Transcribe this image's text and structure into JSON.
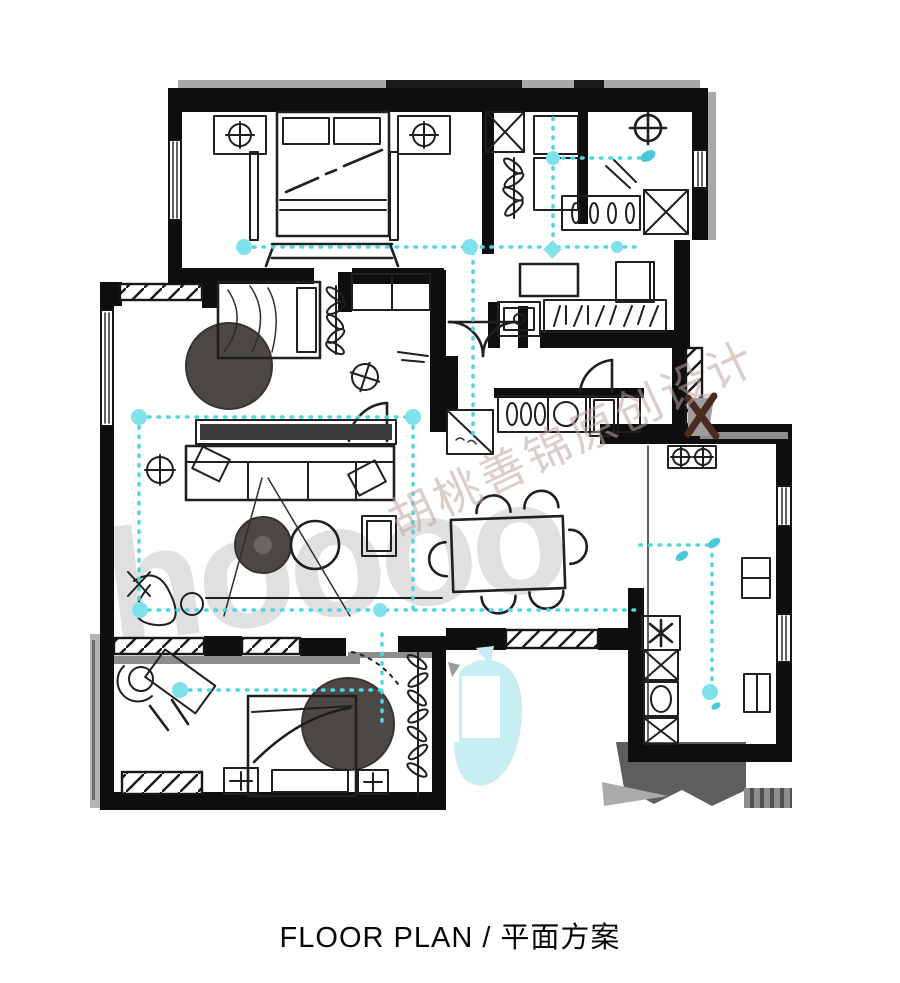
{
  "caption": {
    "text": "FLOOR PLAN / 平面方案"
  },
  "watermark": {
    "logo_text": "hoooo",
    "brand_text": "胡桃善锦原创设计"
  },
  "palette": {
    "wall_black": "#0e0e0e",
    "sketch_line": "#1f1f1f",
    "ceiling_line_cyan": "#52d5e3",
    "ceiling_node_cyan": "#7fe2ea",
    "highlight_cyan": "#c7eef3",
    "rug_dark_gray": "#4c4846",
    "window_sill_gray": "#8d8d8d",
    "shadow_gray": "#5e5e5e",
    "demolition_mark_brown": "#4a2c20",
    "logo_watermark_gray": "#e0e0e0",
    "brand_watermark_tone": "#bda69f"
  },
  "plan": {
    "kind": "hand-drawn residential floor plan sketch",
    "depicted_elements": [
      "double-bed-with-nightstands-and-lamps",
      "bed-bench",
      "wardrobe-hangers",
      "walk-in-closet-shelving",
      "shower-head-symbol",
      "towel-rail",
      "column-x-hatch",
      "entry-double-door",
      "coat-closet-hangers",
      "washbasin",
      "hall-table-and-chair",
      "shoe-cabinet",
      "kitchen-stove-burners",
      "kitchen-sink",
      "refrigerator",
      "dining-table-with-six-chairs",
      "sofa-with-cushions",
      "tv-console",
      "round-coffee-tables",
      "floor-lamp",
      "square-side-table",
      "single-bed",
      "round-area-rug",
      "half-round-area-rug",
      "desk-with-chair",
      "washing-machine",
      "plant",
      "window-seats",
      "ceiling-light-dashed-lines",
      "light-node-dots",
      "demolition-x-mark",
      "cyan-highlighted-wet-area",
      "window-hatch-openings"
    ]
  }
}
